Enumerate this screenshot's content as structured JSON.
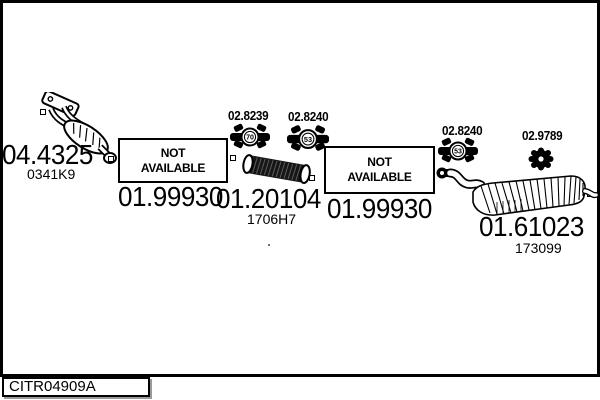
{
  "footer": {
    "code": "CITR04909A"
  },
  "na_box": {
    "line1": "NOT",
    "line2": "AVAILABLE"
  },
  "parts": {
    "manifold": {
      "number": "04.4325",
      "ref": "0341K9"
    },
    "downpipe": {
      "number": "01.99930"
    },
    "clamp_a": {
      "number": "02.8239",
      "size": "70"
    },
    "flex_pipe": {
      "number": "01.20104",
      "ref": "1706H7"
    },
    "clamp_b": {
      "number": "02.8240",
      "size": "53"
    },
    "center_pipe": {
      "number": "01.99930"
    },
    "clamp_c": {
      "number": "02.8240",
      "size": "53"
    },
    "rubber_hanger": {
      "number": "02.9789"
    },
    "rear_silencer": {
      "number": "01.61023",
      "ref": "173099"
    }
  },
  "colors": {
    "ink": "#000000",
    "paper": "#ffffff"
  }
}
